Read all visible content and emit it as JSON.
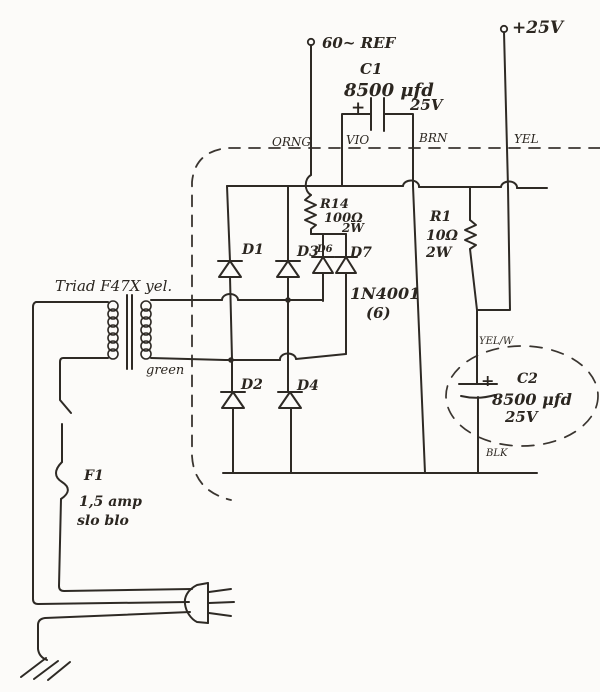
{
  "terminals": {
    "ref": "60~ REF",
    "vplus": "+25V"
  },
  "chassis_wires": {
    "orng": "ORNG",
    "vio": "VIO",
    "brn": "BRN",
    "yel": "YEL",
    "yel_w": "YEL/W",
    "blk": "BLK",
    "green": "green"
  },
  "c1": {
    "name": "C1",
    "value": "8500 μfd",
    "voltage": "25V",
    "polarity": "+"
  },
  "c2": {
    "name": "C2",
    "value": "8500 μfd",
    "voltage": "25V",
    "polarity": "+"
  },
  "r14": {
    "name": "R14",
    "value": "100Ω",
    "power": "2W"
  },
  "r1": {
    "name": "R1",
    "value": "10Ω",
    "power": "2W"
  },
  "diodes": {
    "d1": "D1",
    "d2": "D2",
    "d3": "D3",
    "d4": "D4",
    "d6": "D6",
    "d7": "D7",
    "part": "1N4001",
    "quantity": "(6)"
  },
  "transformer": {
    "label": "Triad F47X yel."
  },
  "fuse": {
    "name": "F1",
    "rating": "1,5 amp",
    "type": "slo blo"
  },
  "colors": {
    "ink": "#2e2a25",
    "paper": "#fcfbf9"
  }
}
